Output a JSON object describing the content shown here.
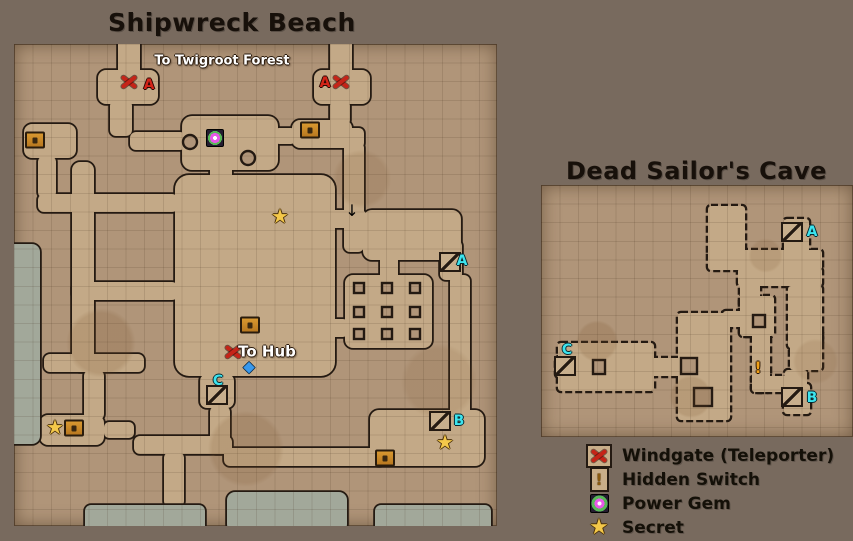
{
  "titles": {
    "shipwreck": "Shipwreck Beach",
    "dead_sailors": "Dead Sailor's Cave"
  },
  "colors": {
    "background": "#786a5e",
    "parchment": "#b09579",
    "floor": "#c3a987",
    "wall": "#241a12",
    "water": "#a2a89a",
    "windgate_red": "#c52418",
    "letter_cyan": "#3ce4ee",
    "secret_star": "#f4c84a",
    "title_text": "#17100a"
  },
  "maps": {
    "shipwreck": {
      "name": "Shipwreck Beach",
      "panel": {
        "x": 14,
        "y": 44,
        "w": 483,
        "h": 482
      },
      "markers": [
        {
          "type": "label",
          "text": "To Twigroot Forest",
          "x": 208,
          "y": 17,
          "size": 13
        },
        {
          "type": "windgate",
          "x": 115,
          "y": 38
        },
        {
          "type": "letter-red",
          "text": "A",
          "x": 135,
          "y": 41
        },
        {
          "type": "letter-red",
          "text": "A",
          "x": 311,
          "y": 39
        },
        {
          "type": "windgate",
          "x": 327,
          "y": 38
        },
        {
          "type": "chest",
          "x": 21,
          "y": 96
        },
        {
          "type": "gem",
          "x": 201,
          "y": 94
        },
        {
          "type": "chest",
          "x": 296,
          "y": 86
        },
        {
          "type": "star",
          "x": 266,
          "y": 172
        },
        {
          "type": "arrow-down",
          "x": 338,
          "y": 167
        },
        {
          "type": "stairs",
          "x": 436,
          "y": 218
        },
        {
          "type": "letter-cyan",
          "text": "A",
          "x": 448,
          "y": 217
        },
        {
          "type": "chest",
          "x": 236,
          "y": 281
        },
        {
          "type": "windgate",
          "x": 219,
          "y": 308
        },
        {
          "type": "label",
          "text": "To Hub",
          "x": 253,
          "y": 308,
          "size": 15
        },
        {
          "type": "diamond",
          "x": 235,
          "y": 323
        },
        {
          "type": "letter-cyan",
          "text": "C",
          "x": 204,
          "y": 337
        },
        {
          "type": "stairs",
          "x": 203,
          "y": 351
        },
        {
          "type": "star",
          "x": 41,
          "y": 383
        },
        {
          "type": "chest",
          "x": 60,
          "y": 384
        },
        {
          "type": "stairs",
          "x": 426,
          "y": 377
        },
        {
          "type": "letter-cyan",
          "text": "B",
          "x": 445,
          "y": 377
        },
        {
          "type": "star",
          "x": 431,
          "y": 398
        },
        {
          "type": "chest",
          "x": 371,
          "y": 414
        }
      ]
    },
    "dead_sailors": {
      "name": "Dead Sailor's Cave",
      "panel": {
        "x": 541,
        "y": 185,
        "w": 312,
        "h": 252
      },
      "markers": [
        {
          "type": "stairs",
          "x": 251,
          "y": 47
        },
        {
          "type": "letter-cyan",
          "text": "A",
          "x": 271,
          "y": 47
        },
        {
          "type": "letter-cyan",
          "text": "C",
          "x": 26,
          "y": 165
        },
        {
          "type": "stairs",
          "x": 24,
          "y": 181
        },
        {
          "type": "switch",
          "text": "!",
          "x": 217,
          "y": 183
        },
        {
          "type": "stairs",
          "x": 251,
          "y": 212
        },
        {
          "type": "letter-cyan",
          "text": "B",
          "x": 271,
          "y": 213
        }
      ]
    }
  },
  "legend": {
    "items": [
      {
        "icon": "windgate-icon",
        "label": "Windgate (Teleporter)"
      },
      {
        "icon": "hidden-switch-icon",
        "label": "Hidden Switch"
      },
      {
        "icon": "power-gem-icon",
        "label": "Power Gem"
      },
      {
        "icon": "secret-star-icon",
        "label": "Secret"
      }
    ]
  }
}
